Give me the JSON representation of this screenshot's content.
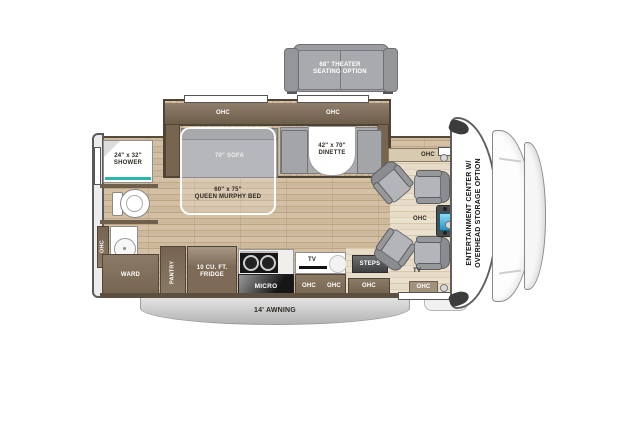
{
  "labels": {
    "ohc": "OHC",
    "tv": "TV"
  },
  "theater_option": {
    "line1": "68\" THEATER",
    "line2": "SEATING OPTION"
  },
  "bedroom": {
    "sofa": "70\" SOFA",
    "murphy_line1": "60\" x 75\"",
    "murphy_line2": "QUEEN MURPHY BED"
  },
  "dinette": {
    "line1": "42\" x 70\"",
    "line2": "DINETTE"
  },
  "bathroom": {
    "shower_line1": "24\" x 32\"",
    "shower_line2": "SHOWER"
  },
  "storage": {
    "ward": "WARD",
    "pantry": "PANTRY",
    "fridge_line1": "10 CU. FT.",
    "fridge_line2": "FRIDGE",
    "micro": "MICRO"
  },
  "entry": {
    "steps": "STEPS"
  },
  "cab": {
    "entertainment_line1": "ENTERTAINMENT CENTER W/",
    "entertainment_line2": "OVERHEAD STORAGE OPTION"
  },
  "exterior": {
    "awning": "14' AWNING"
  },
  "colors": {
    "wood": "#c9b294",
    "cabinet_brown": "#7b6a57",
    "shower_glass_teal": "#2cb6ae",
    "dash_screen_blue": "#2a9fd4",
    "furniture_gray": "#a6a8ab"
  }
}
